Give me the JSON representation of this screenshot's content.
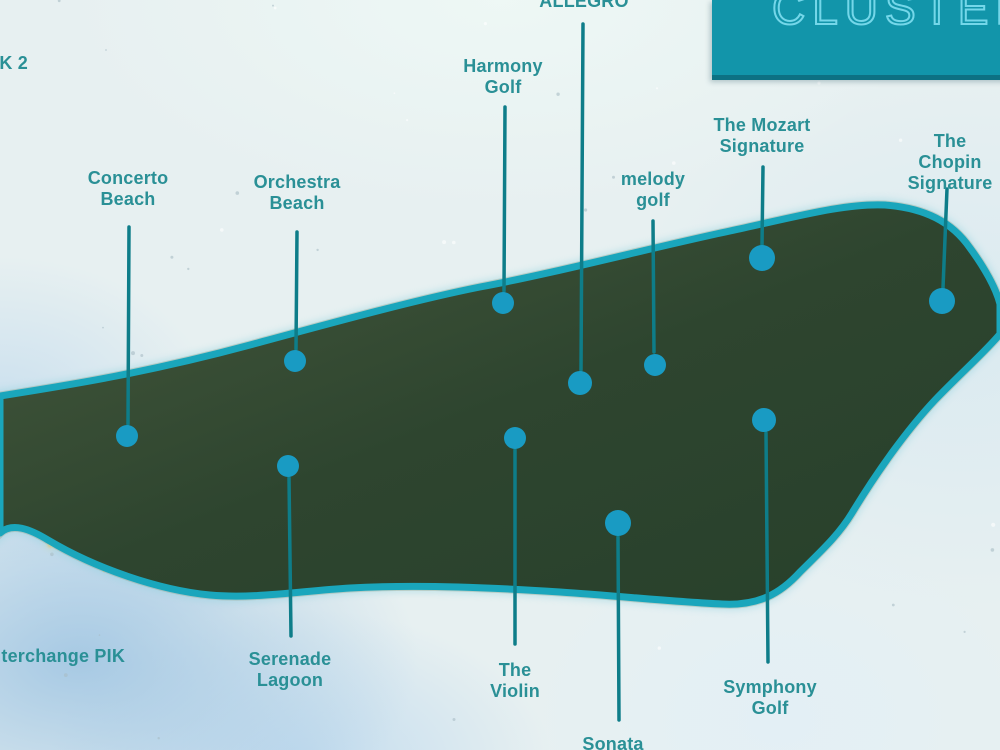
{
  "title_box": {
    "label": "CLUSTER"
  },
  "colors": {
    "label_text": "#2a9096",
    "callout_line": "#0e7d89",
    "marker_dot": "#199bc3",
    "coastline": "#1aa6bc",
    "title_box_bg": "#1295aa",
    "title_box_text": "#74d7e9"
  },
  "clusters": [
    {
      "id": "pik-2",
      "label": "PIK 2",
      "lx": 5,
      "ly": 53,
      "line": null,
      "dot": null
    },
    {
      "id": "concerto-beach",
      "label": "Concerto\nBeach",
      "lx": 128,
      "ly": 168,
      "line": [
        129,
        227,
        128,
        424
      ],
      "dot": [
        127,
        436,
        11
      ]
    },
    {
      "id": "orchestra-beach",
      "label": "Orchestra\nBeach",
      "lx": 297,
      "ly": 172,
      "line": [
        297,
        232,
        296,
        349
      ],
      "dot": [
        295,
        361,
        11
      ]
    },
    {
      "id": "harmony-golf",
      "label": "Harmony\nGolf",
      "lx": 503,
      "ly": 56,
      "line": [
        505,
        107,
        504,
        291
      ],
      "dot": [
        503,
        303,
        11
      ]
    },
    {
      "id": "allegro",
      "label": "ALLEGRO",
      "lx": 584,
      "ly": -9,
      "line": [
        583,
        24,
        581,
        370
      ],
      "dot": [
        580,
        383,
        12
      ]
    },
    {
      "id": "melody-golf",
      "label": "melody\ngolf",
      "lx": 653,
      "ly": 169,
      "line": [
        653,
        221,
        654,
        352
      ],
      "dot": [
        655,
        365,
        11
      ]
    },
    {
      "id": "the-mozart-signature",
      "label": "The Mozart\nSignature",
      "lx": 762,
      "ly": 115,
      "line": [
        763,
        167,
        762,
        245
      ],
      "dot": [
        762,
        258,
        13
      ]
    },
    {
      "id": "the-chopin-signature",
      "label": "The Chopin\nSignature",
      "lx": 950,
      "ly": 131,
      "line": [
        947,
        189,
        943,
        288
      ],
      "dot": [
        942,
        301,
        13
      ]
    },
    {
      "id": "interchange-pik",
      "label": "Interchange PIK",
      "lx": 55,
      "ly": 646,
      "line": null,
      "dot": null
    },
    {
      "id": "serenade-lagoon",
      "label": "Serenade\nLagoon",
      "lx": 290,
      "ly": 649,
      "line": [
        289,
        478,
        291,
        636
      ],
      "dot": [
        288,
        466,
        11
      ]
    },
    {
      "id": "the-violin",
      "label": "The\nViolin",
      "lx": 515,
      "ly": 660,
      "line": [
        515,
        450,
        515,
        644
      ],
      "dot": [
        515,
        438,
        11
      ]
    },
    {
      "id": "sonata",
      "label": "Sonata",
      "lx": 613,
      "ly": 734,
      "line": [
        618,
        537,
        619,
        720
      ],
      "dot": [
        618,
        523,
        13
      ]
    },
    {
      "id": "symphony-golf",
      "label": "Symphony\nGolf",
      "lx": 770,
      "ly": 677,
      "line": [
        766,
        433,
        768,
        662
      ],
      "dot": [
        764,
        420,
        12
      ]
    }
  ]
}
